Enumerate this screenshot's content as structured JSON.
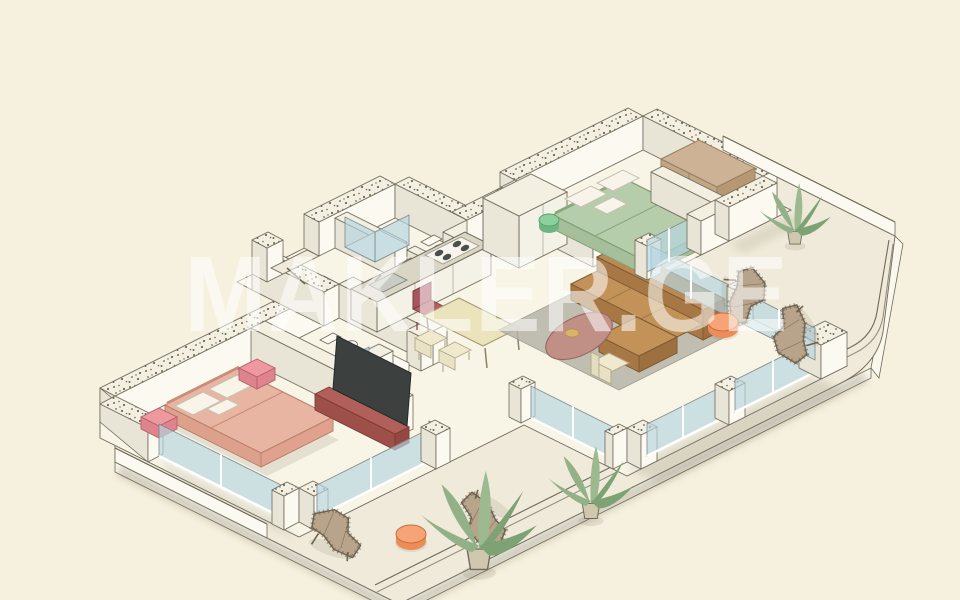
{
  "watermark": {
    "text": "MAKLER.GE"
  },
  "palette": {
    "bg": "#f6f1de",
    "terrace": "#efead9",
    "floor": "#f8f4e6",
    "slabFace": "#faf7ec",
    "wallFace": "#fbf9f0",
    "wallSide": "#e9e5d6",
    "wallTop": "#f3f0e2",
    "outline": "#6f695a",
    "speckleDot": "#6d675a",
    "glass": "#b7d6e0",
    "glassFrame": "#7e8a8c",
    "mullion": "#ffffff",
    "bedPink": "#e9b5a3",
    "bedPinkDark": "#e0a28e",
    "bedPinkSide": "#dda08b",
    "pillow": "#f8f4ea",
    "nightstand": "#ee99a0",
    "nightstandDark": "#df838c",
    "bedGreen": "#b5cdab",
    "bedGreenDark": "#a4bf99",
    "poufGreen": "#8ecf9e",
    "poufGreenDark": "#6fb583",
    "wardrobe": "#cdb295",
    "wardrobeDark": "#b69872",
    "sofa": "#c29258",
    "sofaDark": "#a87844",
    "sofaEnd": "#9e7040",
    "rug": "#b7b4a8",
    "coffeeTable": "#c08f86",
    "coffeeTableDark": "#b07f76",
    "gold": "#d9b36a",
    "tvConsole": "#b06058",
    "tvConsoleDark": "#9e4f48",
    "tvScreen": "#3c4140",
    "table": "#eae3bc",
    "chairRed": "#a9545e",
    "chairCream": "#efe9cd",
    "counterTop": "#dad6c6",
    "cabinetFace": "#f4f1e6",
    "cabinetSide": "#eae6d8",
    "sink": "#c9ccc4",
    "burner": "#4a4f4c",
    "wicker": "#b7a48a",
    "wickerDark": "#6e6250",
    "poufOrange": "#f6a376",
    "poufOrangeDark": "#ec8c58",
    "plant1": "#93b189",
    "plant2": "#9db990",
    "plant3": "#7da273",
    "pot": "#cfc7ae",
    "shadow": "#7c7660",
    "watermark": "#ffffff"
  },
  "scene": {
    "type": "axonometric-floor-plan",
    "rooms": [
      {
        "name": "bedroom-1",
        "features": [
          "pink-double-bed",
          "pillows",
          "pink-nightstands",
          "tv-console",
          "sliding-glass-doors"
        ]
      },
      {
        "name": "bathroom-1",
        "features": [
          "glass-shower",
          "toilet",
          "sink"
        ]
      },
      {
        "name": "bathroom-2",
        "features": [
          "glass-shower",
          "toilet"
        ]
      },
      {
        "name": "entry-hall",
        "features": [
          "recessed-entry-door"
        ]
      },
      {
        "name": "kitchen",
        "features": [
          "counter",
          "sink",
          "cooktop",
          "tall-cabinet"
        ]
      },
      {
        "name": "dining-area",
        "features": [
          "table",
          "red-chair",
          "two-cream-chairs"
        ]
      },
      {
        "name": "living-room",
        "features": [
          "gray-rug",
          "brown-l-sofa",
          "oval-coffee-table",
          "cream-armchair",
          "glass-walls"
        ]
      },
      {
        "name": "bedroom-2",
        "features": [
          "green-double-bed",
          "pillows",
          "green-poufs",
          "wardrobe",
          "glass-door"
        ]
      },
      {
        "name": "terrace",
        "features": [
          "wicker-lounge-chairs",
          "orange-poufs",
          "potted-plants",
          "railing",
          "parapet-walls"
        ]
      }
    ]
  }
}
